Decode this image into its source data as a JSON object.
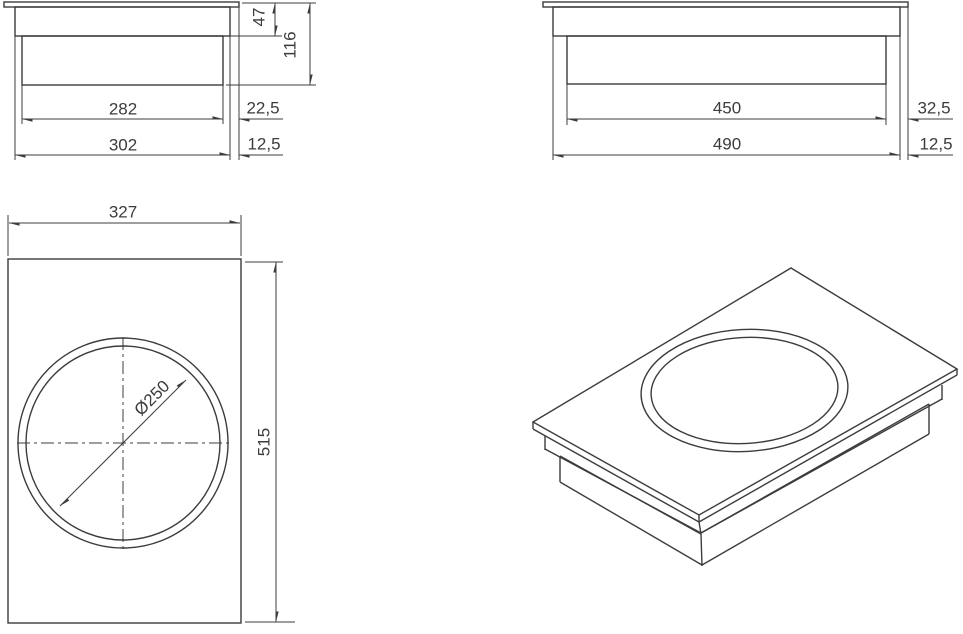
{
  "page": {
    "background": "#ffffff",
    "line_color": "#3c3c3c",
    "text_color": "#3c3c3c",
    "description": "Dimensioned technical drawing of a built-in wok induction cooktop: two section views, one top view, one isometric view"
  },
  "views": {
    "side_front": {
      "labels": {
        "glass_to_flange_depth": "47",
        "total_depth": "116",
        "body_width": "282",
        "flange_edge_offset": "22,5",
        "flange_width": "302",
        "glass_edge_offset": "12,5"
      }
    },
    "side_right": {
      "labels": {
        "body_width": "450",
        "flange_edge_offset": "32,5",
        "flange_width": "490",
        "glass_edge_offset": "12,5"
      }
    },
    "top": {
      "labels": {
        "overall_width": "327",
        "overall_depth": "515",
        "zone_diameter": "Ø250"
      }
    },
    "isometric": {
      "labels": {}
    }
  }
}
